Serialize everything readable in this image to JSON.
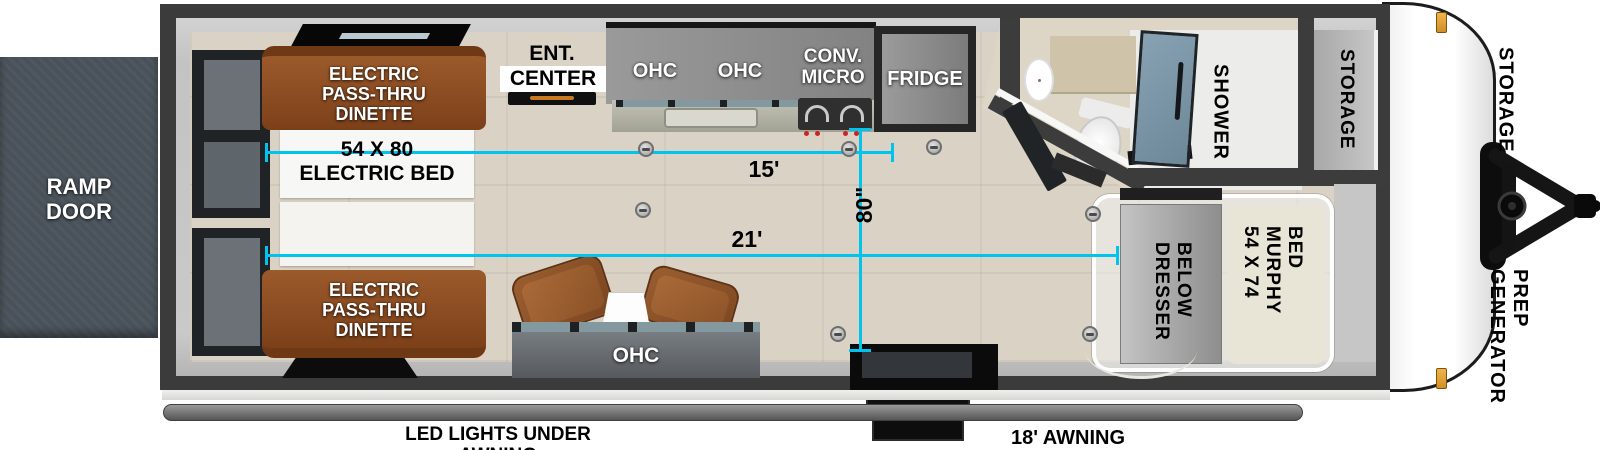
{
  "colors": {
    "accent_cyan": "#00C3EE",
    "dinette_brown": "#8A4C24",
    "chair_brown": "#8A5227",
    "shower_door_blue": "#7B96A8",
    "wall_dark": "#3B3B3B"
  },
  "exterior": {
    "ramp_door": "RAMP\nDOOR",
    "front_storage": "STORAGE",
    "generator_prep": "GENERATOR\nPREP",
    "awning_length": "18' AWNING",
    "led_lights": "LED LIGHTS UNDER AWNING"
  },
  "living_area": {
    "dinette_top": "ELECTRIC\nPASS-THRU\nDINETTE",
    "electric_bed": "54 X 80\nELECTRIC BED",
    "dinette_bottom": "ELECTRIC\nPASS-THRU\nDINETTE",
    "ent_center_top": "ENT.",
    "ent_center_bottom": "CENTER",
    "sofa_ohc": "OHC"
  },
  "kitchen": {
    "ohc_left": "OHC",
    "ohc_right": "OHC",
    "conv_micro": "CONV.\nMICRO",
    "fridge": "FRIDGE"
  },
  "bathroom": {
    "shower": "SHOWER"
  },
  "bedroom": {
    "storage_closet": "STORAGE",
    "murphy_bed": "54 X 74\nMURPHY BED",
    "dresser": "DRESSER\nBELOW"
  },
  "dimensions": {
    "kitchen_length": "15'",
    "main_length": "21'",
    "interior_width": "80\""
  }
}
